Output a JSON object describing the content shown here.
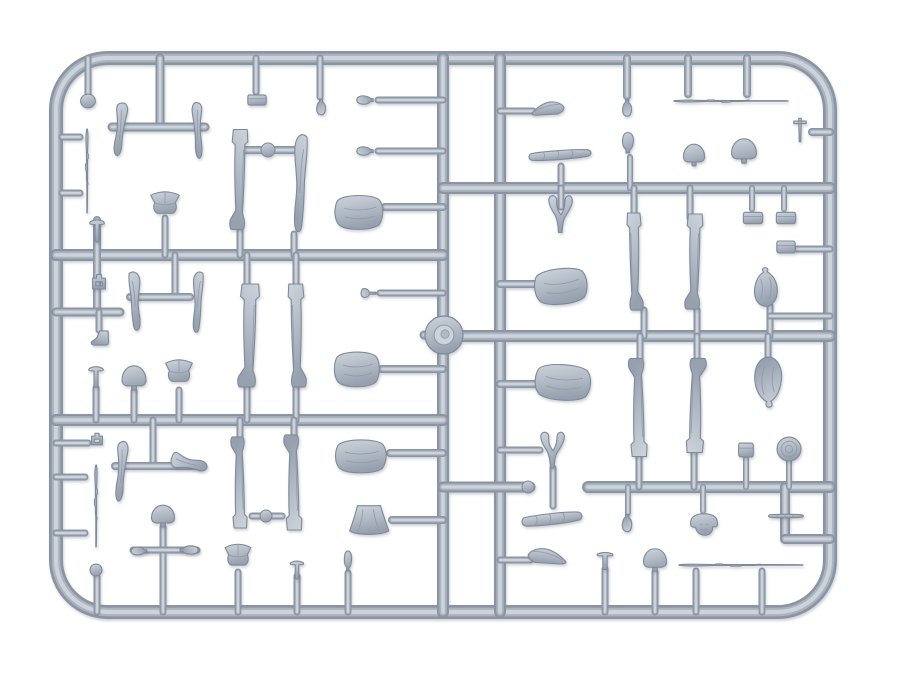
{
  "image": {
    "width": 897,
    "height": 673,
    "description": "Photograph of a light grey injection-molded plastic model kit sprue holding WWII soldier figure parts: legs, torsos, arms, heads, helmets, caps, packs and rifles",
    "background": "#ffffff"
  },
  "colors": {
    "rail_dark": "#8b94a2",
    "rail_mid": "#aab3be",
    "rail_light": "#cdd3db",
    "part_stroke": "#7f8a99",
    "part_crease": "#8f99a7",
    "grad_top": "#cdd4dc",
    "grad_mid": "#b0b9c4",
    "grad_bot": "#96a0ae",
    "hub_inner": "#cdd3da",
    "shadow": "#5f6a7a"
  },
  "sprue": {
    "frame": {
      "x": 56,
      "y": 58,
      "w": 774,
      "h": 554,
      "rx": 52,
      "t": 14
    },
    "rails": [
      [
        443,
        58,
        443,
        612,
        12
      ],
      [
        500,
        58,
        500,
        612,
        12
      ],
      [
        56,
        255,
        443,
        255,
        12
      ],
      [
        56,
        420,
        443,
        420,
        12
      ],
      [
        443,
        188,
        830,
        188,
        12
      ],
      [
        443,
        336,
        830,
        336,
        12
      ],
      [
        443,
        487,
        530,
        487,
        11
      ],
      [
        588,
        487,
        830,
        487,
        12
      ],
      [
        785,
        487,
        785,
        539,
        10
      ],
      [
        785,
        539,
        830,
        539,
        10
      ]
    ],
    "stubs": [
      [
        88,
        58,
        88,
        94,
        7
      ],
      [
        160,
        58,
        160,
        127,
        9
      ],
      [
        112,
        127,
        205,
        127,
        9
      ],
      [
        256,
        58,
        256,
        92,
        7
      ],
      [
        320,
        58,
        320,
        97,
        7
      ],
      [
        378,
        100,
        443,
        100,
        7
      ],
      [
        378,
        151,
        443,
        151,
        7
      ],
      [
        385,
        207,
        443,
        207,
        8
      ],
      [
        240,
        150,
        294,
        150,
        8
      ],
      [
        240,
        231,
        240,
        255,
        7
      ],
      [
        294,
        234,
        294,
        255,
        7
      ],
      [
        165,
        218,
        165,
        255,
        7
      ],
      [
        175,
        255,
        175,
        293,
        7
      ],
      [
        130,
        297,
        190,
        297,
        8
      ],
      [
        97,
        220,
        97,
        312,
        8
      ],
      [
        56,
        312,
        120,
        312,
        9
      ],
      [
        99,
        312,
        99,
        330,
        7
      ],
      [
        62,
        137,
        80,
        137,
        7
      ],
      [
        62,
        193,
        80,
        193,
        7
      ],
      [
        247,
        255,
        247,
        286,
        7
      ],
      [
        247,
        386,
        247,
        420,
        7
      ],
      [
        296,
        255,
        296,
        286,
        7
      ],
      [
        296,
        386,
        296,
        420,
        7
      ],
      [
        380,
        293,
        443,
        293,
        7
      ],
      [
        382,
        369,
        443,
        369,
        8
      ],
      [
        96,
        388,
        96,
        420,
        7
      ],
      [
        134,
        391,
        134,
        420,
        7
      ],
      [
        179,
        390,
        179,
        420,
        7
      ],
      [
        627,
        58,
        627,
        96,
        8
      ],
      [
        688,
        58,
        688,
        94,
        8
      ],
      [
        747,
        58,
        747,
        94,
        8
      ],
      [
        812,
        132,
        830,
        132,
        8
      ],
      [
        500,
        111,
        533,
        111,
        7
      ],
      [
        630,
        157,
        630,
        188,
        6
      ],
      [
        561,
        166,
        561,
        188,
        7
      ],
      [
        561,
        188,
        561,
        207,
        7
      ],
      [
        634,
        188,
        634,
        216,
        7
      ],
      [
        644,
        310,
        644,
        336,
        7
      ],
      [
        690,
        188,
        690,
        218,
        7
      ],
      [
        697,
        310,
        697,
        336,
        7
      ],
      [
        752,
        188,
        752,
        209,
        6
      ],
      [
        784,
        188,
        784,
        209,
        6
      ],
      [
        500,
        284,
        540,
        284,
        8
      ],
      [
        500,
        384,
        540,
        384,
        8
      ],
      [
        797,
        249,
        830,
        249,
        7
      ],
      [
        770,
        306,
        770,
        336,
        7
      ],
      [
        770,
        316,
        830,
        316,
        7
      ],
      [
        640,
        336,
        640,
        359,
        7
      ],
      [
        639,
        455,
        639,
        487,
        7
      ],
      [
        697,
        336,
        697,
        359,
        7
      ],
      [
        694,
        452,
        694,
        487,
        7
      ],
      [
        768,
        336,
        768,
        358,
        7
      ],
      [
        746,
        459,
        746,
        487,
        6
      ],
      [
        789,
        461,
        789,
        487,
        6
      ],
      [
        628,
        487,
        628,
        513,
        6
      ],
      [
        703,
        487,
        703,
        511,
        6
      ],
      [
        605,
        569,
        605,
        612,
        7
      ],
      [
        655,
        572,
        655,
        612,
        7
      ],
      [
        696,
        571,
        696,
        612,
        7
      ],
      [
        762,
        571,
        762,
        612,
        7
      ],
      [
        97,
        577,
        97,
        612,
        7
      ],
      [
        163,
        527,
        163,
        612,
        7
      ],
      [
        133,
        550,
        197,
        550,
        7
      ],
      [
        238,
        572,
        238,
        612,
        7
      ],
      [
        297,
        576,
        297,
        612,
        7
      ],
      [
        348,
        573,
        348,
        612,
        7
      ],
      [
        56,
        443,
        88,
        443,
        7
      ],
      [
        56,
        477,
        85,
        477,
        7
      ],
      [
        56,
        533,
        85,
        533,
        7
      ],
      [
        153,
        420,
        153,
        462,
        7
      ],
      [
        115,
        466,
        200,
        466,
        8
      ],
      [
        240,
        420,
        240,
        440,
        7
      ],
      [
        294,
        420,
        294,
        437,
        7
      ],
      [
        390,
        453,
        443,
        453,
        8
      ],
      [
        392,
        520,
        443,
        520,
        8
      ],
      [
        553,
        468,
        553,
        506,
        7
      ],
      [
        500,
        450,
        540,
        450,
        7
      ],
      [
        500,
        560,
        530,
        560,
        7
      ],
      [
        252,
        516,
        282,
        516,
        7
      ],
      [
        424,
        335,
        443,
        335,
        9
      ]
    ],
    "knobs": [
      [
        268,
        150,
        7
      ],
      [
        266,
        516,
        6
      ],
      [
        528,
        487,
        6
      ]
    ],
    "hub": {
      "x": 444,
      "y": 335,
      "r": 19
    }
  },
  "parts": [
    {
      "n": "molded-disc",
      "t": "disc",
      "x": 88,
      "y": 101,
      "w": 16,
      "h": 15
    },
    {
      "n": "figure-arm",
      "t": "arm",
      "x": 122,
      "y": 130,
      "w": 30,
      "h": 55,
      "r": 8
    },
    {
      "n": "figure-arm",
      "t": "arm",
      "x": 196,
      "y": 131,
      "w": 26,
      "h": 58,
      "r": -4,
      "f": 1
    },
    {
      "n": "equipment-pouch",
      "t": "box",
      "x": 257,
      "y": 100,
      "w": 20,
      "h": 17
    },
    {
      "n": "figure-head",
      "t": "head",
      "x": 321,
      "y": 106,
      "w": 17,
      "h": 19,
      "r": 180
    },
    {
      "n": "figure-head",
      "t": "head",
      "x": 366,
      "y": 100,
      "w": 16,
      "h": 20,
      "r": -90
    },
    {
      "n": "figure-head",
      "t": "head",
      "x": 366,
      "y": 151,
      "w": 16,
      "h": 20,
      "r": -90
    },
    {
      "n": "figure-torso",
      "t": "torso",
      "x": 359,
      "y": 212,
      "w": 50,
      "h": 40
    },
    {
      "n": "winter-hat",
      "t": "ushanka",
      "x": 165,
      "y": 205,
      "w": 31,
      "h": 27
    },
    {
      "n": "figure-leg",
      "t": "leg",
      "x": 240,
      "y": 180,
      "w": 30,
      "h": 101,
      "f": 1
    },
    {
      "n": "figure-leg-bent",
      "t": "legbent",
      "x": 298,
      "y": 183,
      "w": 32,
      "h": 100,
      "f": 1
    },
    {
      "n": "rifle",
      "t": "rifle",
      "x": 87,
      "y": 171,
      "w": 84,
      "h": 18,
      "r": 90
    },
    {
      "n": "figure-leg-bent",
      "t": "legbent",
      "x": 137,
      "y": 301,
      "w": 28,
      "h": 60
    },
    {
      "n": "figure-leg-bent",
      "t": "legbent",
      "x": 196,
      "y": 302,
      "w": 25,
      "h": 62,
      "f": 1
    },
    {
      "n": "stud-part",
      "t": "tack",
      "x": 97,
      "y": 231,
      "w": 22,
      "h": 26
    },
    {
      "n": "buckle-part",
      "t": "buckle",
      "x": 99,
      "y": 283,
      "w": 20,
      "h": 20
    },
    {
      "n": "boot",
      "t": "boot",
      "x": 100,
      "y": 338,
      "w": 25,
      "h": 22,
      "f": 1
    },
    {
      "n": "knob-part",
      "t": "knob",
      "x": 368,
      "y": 293,
      "w": 20,
      "h": 21,
      "r": -90
    },
    {
      "n": "figure-leg",
      "t": "leg",
      "x": 250,
      "y": 336,
      "w": 36,
      "h": 104,
      "f": 1
    },
    {
      "n": "figure-leg",
      "t": "leg",
      "x": 296,
      "y": 336,
      "w": 30,
      "h": 104
    },
    {
      "n": "figure-torso",
      "t": "torso",
      "x": 357,
      "y": 369,
      "w": 47,
      "h": 41
    },
    {
      "n": "stud-part",
      "t": "tack",
      "x": 96,
      "y": 377,
      "w": 22,
      "h": 24
    },
    {
      "n": "helmet",
      "t": "helmet",
      "x": 134,
      "y": 378,
      "w": 26,
      "h": 27
    },
    {
      "n": "winter-hat",
      "t": "ushanka",
      "x": 179,
      "y": 373,
      "w": 29,
      "h": 27
    },
    {
      "n": "rifle",
      "t": "rifle",
      "x": 731,
      "y": 101,
      "w": 114,
      "h": 16
    },
    {
      "n": "figure-head",
      "t": "head",
      "x": 627,
      "y": 107,
      "w": 17,
      "h": 20,
      "r": 180
    },
    {
      "n": "tool-part",
      "t": "tool",
      "x": 800,
      "y": 130,
      "w": 26,
      "h": 28
    },
    {
      "n": "figure-head",
      "t": "head",
      "x": 628,
      "y": 144,
      "w": 21,
      "h": 25
    },
    {
      "n": "helmet",
      "t": "helmet",
      "x": 694,
      "y": 155,
      "w": 23,
      "h": 24
    },
    {
      "n": "helmet",
      "t": "helmet",
      "x": 744,
      "y": 151,
      "w": 27,
      "h": 27
    },
    {
      "n": "side-cap",
      "t": "pilotka",
      "x": 548,
      "y": 110,
      "w": 34,
      "h": 26
    },
    {
      "n": "bedroll",
      "t": "roll",
      "x": 560,
      "y": 155,
      "w": 64,
      "h": 24,
      "r": -4
    },
    {
      "n": "arms-pair",
      "t": "varm",
      "x": 561,
      "y": 214,
      "w": 36,
      "h": 40
    },
    {
      "n": "equipment-pouch",
      "t": "box",
      "x": 753,
      "y": 218,
      "w": 21,
      "h": 19
    },
    {
      "n": "equipment-pouch",
      "t": "box",
      "x": 786,
      "y": 218,
      "w": 21,
      "h": 19
    },
    {
      "n": "figure-leg",
      "t": "leg",
      "x": 634,
      "y": 262,
      "w": 27,
      "h": 98
    },
    {
      "n": "figure-leg",
      "t": "leg",
      "x": 695,
      "y": 262,
      "w": 30,
      "h": 96,
      "f": 1
    },
    {
      "n": "figure-torso",
      "t": "torso",
      "x": 561,
      "y": 286,
      "w": 55,
      "h": 42,
      "r": -6
    },
    {
      "n": "figure-torso",
      "t": "torso",
      "x": 563,
      "y": 382,
      "w": 58,
      "h": 42,
      "r": 4
    },
    {
      "n": "equipment-pouch",
      "t": "box",
      "x": 786,
      "y": 247,
      "w": 20,
      "h": 20
    },
    {
      "n": "duffel-bag",
      "t": "sack",
      "x": 766,
      "y": 287,
      "w": 34,
      "h": 40
    },
    {
      "n": "figure-leg",
      "t": "leg",
      "x": 639,
      "y": 407,
      "w": 31,
      "h": 99,
      "r": 180
    },
    {
      "n": "figure-leg",
      "t": "leg",
      "x": 695,
      "y": 405,
      "w": 33,
      "h": 95,
      "r": 180,
      "f": 1
    },
    {
      "n": "duffel-bag",
      "t": "sack",
      "x": 768,
      "y": 382,
      "w": 40,
      "h": 52,
      "r": 180
    },
    {
      "n": "equipment-pouch",
      "t": "box",
      "x": 746,
      "y": 450,
      "w": 16,
      "h": 23
    },
    {
      "n": "drum-magazine",
      "t": "dlid",
      "x": 789,
      "y": 449,
      "w": 26,
      "h": 26
    },
    {
      "n": "figure-head",
      "t": "head",
      "x": 627,
      "y": 522,
      "w": 18,
      "h": 21,
      "r": 180
    },
    {
      "n": "helmeted-head",
      "t": "helmface",
      "x": 704,
      "y": 525,
      "w": 31,
      "h": 31
    },
    {
      "n": "cleaning-rod",
      "t": "roll",
      "x": 786,
      "y": 516,
      "w": 36,
      "h": 9
    },
    {
      "n": "stud-part",
      "t": "tack",
      "x": 605,
      "y": 561,
      "w": 24,
      "h": 20
    },
    {
      "n": "helmet",
      "t": "helmet",
      "x": 655,
      "y": 560,
      "w": 25,
      "h": 25
    },
    {
      "n": "rifle",
      "t": "rifle",
      "x": 741,
      "y": 565,
      "w": 124,
      "h": 15
    },
    {
      "n": "buckle-part",
      "t": "buckle",
      "x": 97,
      "y": 440,
      "w": 17,
      "h": 16
    },
    {
      "n": "figure-arm",
      "t": "arm",
      "x": 123,
      "y": 472,
      "w": 28,
      "h": 62,
      "r": 6
    },
    {
      "n": "figure-arm",
      "t": "arm",
      "x": 189,
      "y": 466,
      "w": 40,
      "h": 38,
      "r": -80,
      "f": 1
    },
    {
      "n": "rifle",
      "t": "rifle",
      "x": 96,
      "y": 506,
      "w": 82,
      "h": 20,
      "r": 90
    },
    {
      "n": "helmet",
      "t": "helmet",
      "x": 163,
      "y": 516,
      "w": 25,
      "h": 24
    },
    {
      "n": "figure-head",
      "t": "head",
      "x": 140,
      "y": 551,
      "w": 15,
      "h": 19,
      "r": -90
    },
    {
      "n": "figure-head",
      "t": "head",
      "x": 188,
      "y": 550,
      "w": 16,
      "h": 22,
      "r": 90
    },
    {
      "n": "molded-disc",
      "t": "disc",
      "x": 96,
      "y": 570,
      "w": 13,
      "h": 13
    },
    {
      "n": "winter-hat",
      "t": "ushanka",
      "x": 238,
      "y": 557,
      "w": 28,
      "h": 26
    },
    {
      "n": "stud-part",
      "t": "tack",
      "x": 297,
      "y": 570,
      "w": 20,
      "h": 21
    },
    {
      "n": "figure-head",
      "t": "head",
      "x": 348,
      "y": 562,
      "w": 14,
      "h": 24
    },
    {
      "n": "figure-leg",
      "t": "leg",
      "x": 240,
      "y": 482,
      "w": 27,
      "h": 92,
      "r": 180
    },
    {
      "n": "figure-leg",
      "t": "leg",
      "x": 294,
      "y": 482,
      "w": 30,
      "h": 96,
      "r": 180
    },
    {
      "n": "figure-torso",
      "t": "torso",
      "x": 361,
      "y": 456,
      "w": 53,
      "h": 39
    },
    {
      "n": "coat-skirt",
      "t": "skirt",
      "x": 369,
      "y": 520,
      "w": 43,
      "h": 34
    },
    {
      "n": "arms-pair",
      "t": "varm",
      "x": 553,
      "y": 450,
      "w": 36,
      "h": 39
    },
    {
      "n": "bedroll",
      "t": "roll",
      "x": 552,
      "y": 519,
      "w": 62,
      "h": 29,
      "r": -6
    },
    {
      "n": "side-cap",
      "t": "pilotka",
      "x": 547,
      "y": 558,
      "w": 40,
      "h": 30,
      "f": 1
    }
  ]
}
